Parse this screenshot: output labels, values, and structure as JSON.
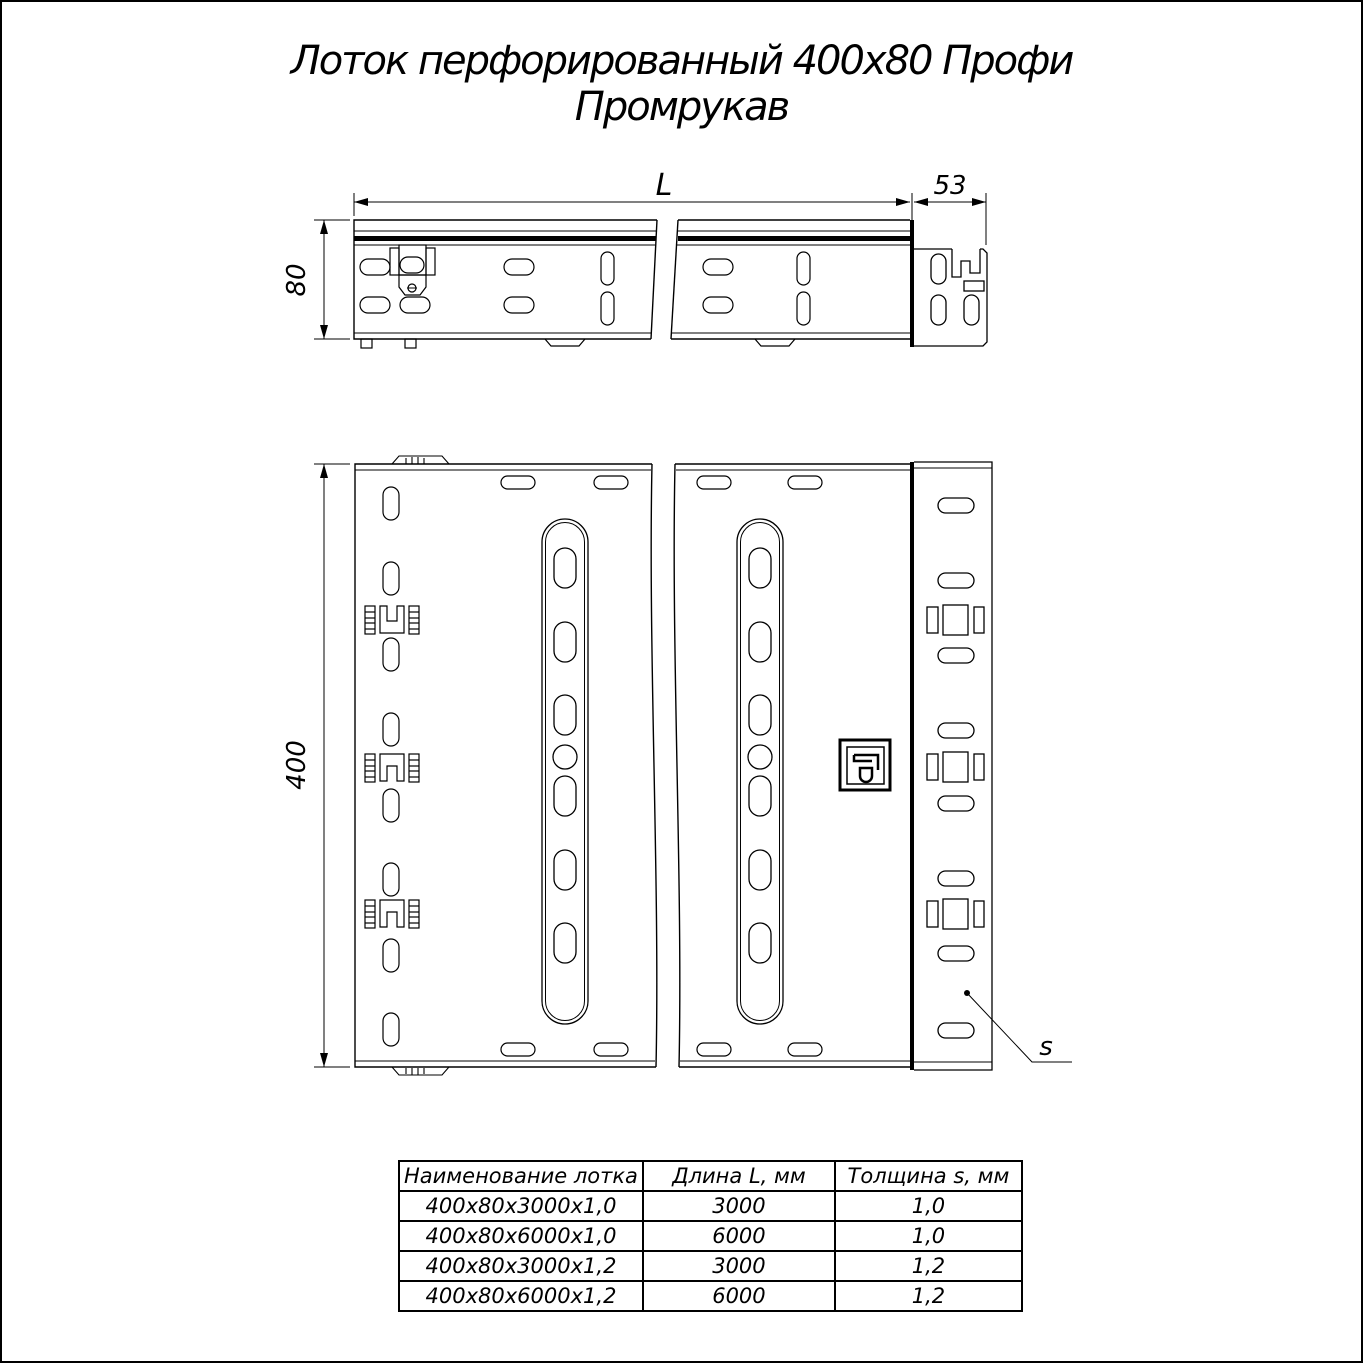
{
  "title": {
    "line1": "Лоток перфорированный 400х80 Профи",
    "line2": "Промрукав"
  },
  "drawing": {
    "dim_length_label": "L",
    "dim_end_width": "53",
    "dim_height": "80",
    "dim_width": "400",
    "dim_thickness_label": "s"
  },
  "table": {
    "headers": [
      "Наименование лотка",
      "Длина L, мм",
      "Толщина s, мм"
    ],
    "rows": [
      {
        "name": "400х80х3000х1,0",
        "length": "3000",
        "thickness": "1,0"
      },
      {
        "name": "400х80х6000х1,0",
        "length": "6000",
        "thickness": "1,0"
      },
      {
        "name": "400х80х3000х1,2",
        "length": "3000",
        "thickness": "1,2"
      },
      {
        "name": "400х80х6000х1,2",
        "length": "6000",
        "thickness": "1,2"
      }
    ]
  },
  "colors": {
    "line": "#000000",
    "background": "#ffffff"
  }
}
